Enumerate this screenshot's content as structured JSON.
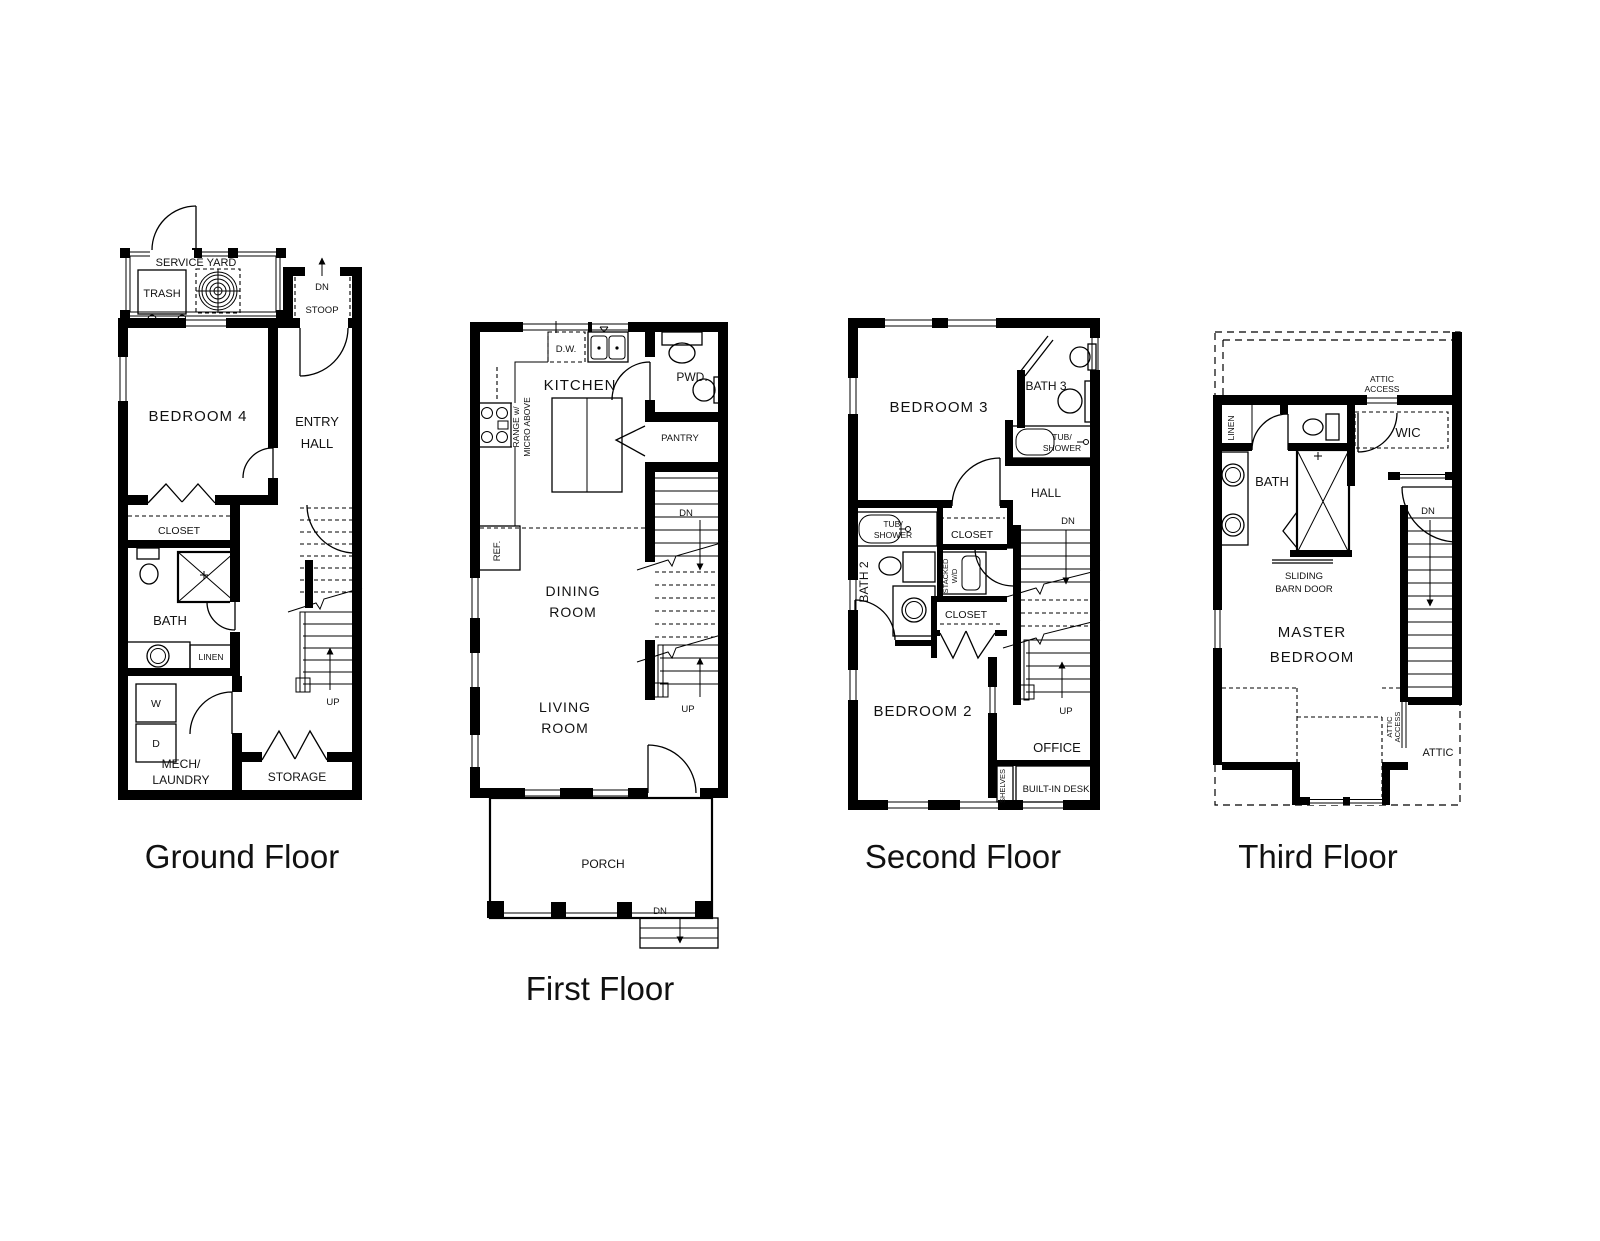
{
  "colors": {
    "background": "#ffffff",
    "linework": "#000000",
    "text": "#111111"
  },
  "floors": {
    "ground": {
      "title": "Ground Floor",
      "labels": {
        "service_yard": "SERVICE YARD",
        "trash": "TRASH",
        "stoop_dn": "DN",
        "stoop": "STOOP",
        "bedroom4": "BEDROOM 4",
        "entry_line1": "ENTRY",
        "entry_line2": "HALL",
        "closet": "CLOSET",
        "bath": "BATH",
        "linen": "LINEN",
        "washer": "W",
        "dryer": "D",
        "mech_line1": "MECH/",
        "mech_line2": "LAUNDRY",
        "storage": "STORAGE",
        "up": "UP"
      }
    },
    "first": {
      "title": "First Floor",
      "labels": {
        "dw": "D.W.",
        "kitchen": "KITCHEN",
        "pwd": "PWD.",
        "range_line1": "RANGE w/",
        "range_line2": "MICRO ABOVE",
        "pantry": "PANTRY",
        "ref": "REF.",
        "dn": "DN",
        "dining_line1": "DINING",
        "dining_line2": "ROOM",
        "living_line1": "LIVING",
        "living_line2": "ROOM",
        "up": "UP",
        "porch": "PORCH",
        "porch_dn": "DN"
      }
    },
    "second": {
      "title": "Second Floor",
      "labels": {
        "bedroom3": "BEDROOM 3",
        "bath3": "BATH 3",
        "tub3_line1": "TUB/",
        "tub3_line2": "SHOWER",
        "hall": "HALL",
        "tub2_line1": "TUB/",
        "tub2_line2": "SHOWER",
        "closet_upper": "CLOSET",
        "bath2": "BATH 2",
        "stacked_line1": "STACKED",
        "stacked_line2": "W/D",
        "closet_lower": "CLOSET",
        "dn": "DN",
        "bedroom2": "BEDROOM 2",
        "up": "UP",
        "office": "OFFICE",
        "shelves": "SHELVES",
        "desk": "BUILT-IN DESK"
      }
    },
    "third": {
      "title": "Third Floor",
      "labels": {
        "attic_access_top_line1": "ATTIC",
        "attic_access_top_line2": "ACCESS",
        "linen": "LINEN",
        "wic": "WIC",
        "bath": "BATH",
        "barn_line1": "SLIDING",
        "barn_line2": "BARN DOOR",
        "dn": "DN",
        "master_line1": "MASTER",
        "master_line2": "BEDROOM",
        "attic_access_side_line1": "ATTIC",
        "attic_access_side_line2": "ACCESS",
        "attic": "ATTIC"
      }
    }
  }
}
